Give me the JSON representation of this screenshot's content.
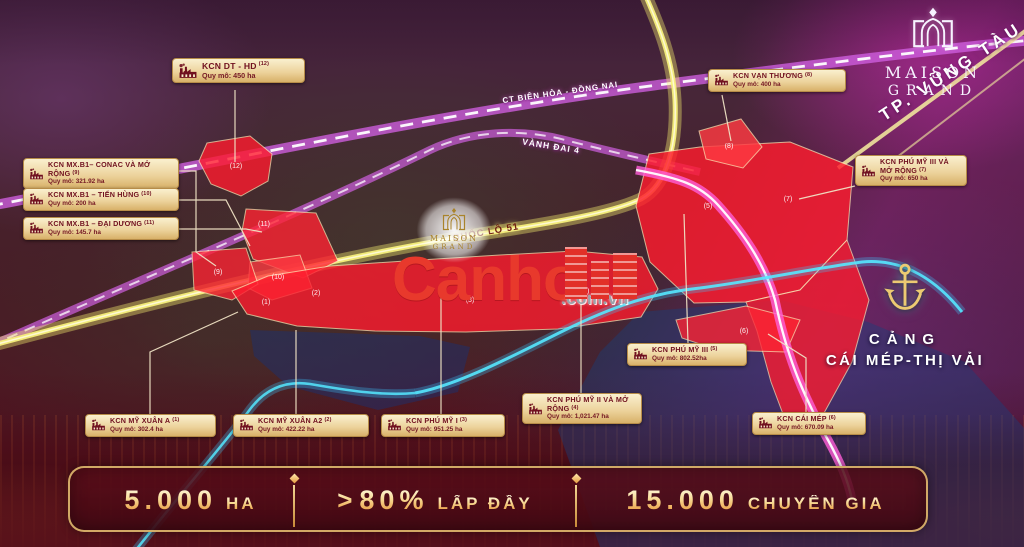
{
  "branding": {
    "logo_top": "MAISON",
    "logo_bottom": "GRAND",
    "city_banner": "TP. VŨNG TÀU"
  },
  "watermark": {
    "brand": "Canho",
    "suffix": ".com.vn"
  },
  "roads": {
    "ct": {
      "label": "CT BIÊN HÒA - ĐỒNG NAI"
    },
    "vd4": {
      "label": "VÀNH ĐAI 4"
    },
    "ql51": {
      "label": "QUỐC LỘ 51"
    }
  },
  "port": {
    "title": "CẢNG",
    "name": "CÁI MÉP-THỊ VẢI"
  },
  "parks": {
    "p1": {
      "name": "KCN MỸ XUÂN A",
      "num": "(1)",
      "area": "Quy mô: 302.4 ha"
    },
    "p2": {
      "name": "KCN MỸ XUÂN A2",
      "num": "(2)",
      "area": "Quy mô: 422.22 ha"
    },
    "p3": {
      "name": "KCN PHÚ MỸ I",
      "num": "(3)",
      "area": "Quy mô: 951.25 ha"
    },
    "p4": {
      "name": "KCN PHÚ MỸ II VÀ MỞ RỘNG",
      "num": "(4)",
      "area": "Quy mô: 1,021.47 ha"
    },
    "p5": {
      "name": "KCN PHÚ MỸ III",
      "num": "(5)",
      "area": "Quy mô: 802.52ha"
    },
    "p6": {
      "name": "KCN CÁI MÉP",
      "num": "(6)",
      "area": "Quy mô: 670.09 ha"
    },
    "p7": {
      "name": "KCN PHÚ MỸ III VÀ MỞ RỘNG",
      "num": "(7)",
      "area": "Quy mô: 650 ha"
    },
    "p8": {
      "name": "KCN VẠN THƯƠNG",
      "num": "(8)",
      "area": "Quy mô: 400 ha"
    },
    "p9": {
      "name": "KCN MX.B1– CONAC VÀ MỞ RỘNG",
      "num": "(9)",
      "area": "Quy mô: 321.92 ha"
    },
    "p10": {
      "name": "KCN MX.B1 – TIẾN HÙNG",
      "num": "(10)",
      "area": "Quy mô: 200 ha"
    },
    "p11": {
      "name": "KCN MX.B1 – ĐẠI DƯƠNG",
      "num": "(11)",
      "area": "Quy mô: 145.7 ha"
    },
    "p12": {
      "name": "KCN DT - HD",
      "num": "(12)",
      "area": "Quy mô: 450 ha"
    }
  },
  "zone_markers": {
    "z1": "(1)",
    "z2": "(2)",
    "z3": "(3)",
    "z4": "(4)",
    "z5": "(5)",
    "z6": "(6)",
    "z7": "(7)",
    "z8": "(8)",
    "z9": "(9)",
    "z10": "(10)",
    "z11": "(11)",
    "z12": "(12)"
  },
  "stats": {
    "s1": {
      "value": "5.000",
      "unit": "HA"
    },
    "s2": {
      "arrow": ">",
      "value": "80%",
      "unit": "LẤP ĐẦY"
    },
    "s3": {
      "value": "15.000",
      "unit": "CHUYÊN GIA"
    }
  },
  "colors": {
    "label_gold": "#ecd29b",
    "label_text_maroon": "#70101f",
    "zone_red": "#ff1c2e",
    "road_yellow": "#f5ee6e",
    "road_magenta": "#cf5fe0",
    "river_cyan": "#55e8ff",
    "watermark_red": "#e8392c",
    "stat_gold": "#f2c877",
    "bar_bg": "#4e0c18"
  }
}
